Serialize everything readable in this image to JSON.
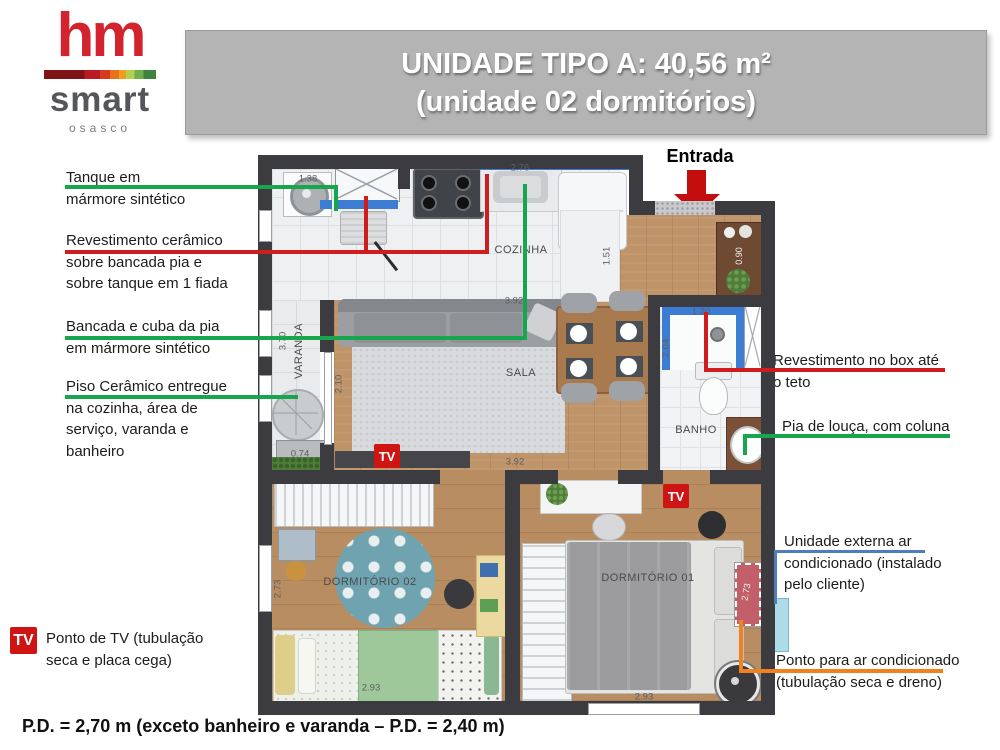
{
  "logo": {
    "hm": "hm",
    "smart": "smart",
    "city": "osasco"
  },
  "banner": {
    "line1": "UNIDADE TIPO A: 40,56 m²",
    "line2": "(unidade 02 dormitórios)"
  },
  "annotations": {
    "left": [
      {
        "id": "tanque",
        "text": "Tanque em\nmármore sintético",
        "line_color": "green"
      },
      {
        "id": "revestimento-ceramico",
        "text": "Revestimento cerâmico\nsobre bancada pia e\nsobre tanque em 1 fiada",
        "line_color": "red"
      },
      {
        "id": "bancada-cuba",
        "text": "Bancada e cuba da pia\nem mármore sintético",
        "line_color": "green"
      },
      {
        "id": "piso-ceramico",
        "text": "Piso Cerâmico entregue\nna cozinha, área de\nserviço, varanda e\nbanheiro",
        "line_color": "green"
      }
    ],
    "right": [
      {
        "id": "revestimento-box",
        "text": "Revestimento no box até\no teto",
        "line_color": "red"
      },
      {
        "id": "pia-louca",
        "text": "Pia de louça, com coluna",
        "line_color": "green"
      },
      {
        "id": "unidade-externa-ac",
        "text": "Unidade externa ar\ncondicionado (instalado\npelo cliente)",
        "line_color": "blue"
      },
      {
        "id": "ponto-ac",
        "text": "Ponto para ar condicionado\n(tubulação seca e dreno)",
        "line_color": "orange"
      }
    ]
  },
  "tv_legend": {
    "icon": "TV",
    "text": "Ponto de TV (tubulação\nseca e placa cega)"
  },
  "footer": "P.D. = 2,70 m (exceto banheiro e varanda – P.D. = 2,40 m)",
  "plan": {
    "entrada_label": "Entrada",
    "tv_label": "TV",
    "labels": [
      {
        "text": "COZINHA",
        "cx": 263,
        "cy": 95,
        "rot": 0,
        "kind": "room"
      },
      {
        "text": "SALA",
        "cx": 263,
        "cy": 218,
        "rot": 0,
        "kind": "room"
      },
      {
        "text": "BANHO",
        "cx": 438,
        "cy": 275,
        "rot": 0,
        "kind": "room"
      },
      {
        "text": "VARANDA",
        "cx": 41,
        "cy": 196,
        "rot": -90,
        "kind": "room"
      },
      {
        "text": "DORMITÓRIO 02",
        "cx": 112,
        "cy": 427,
        "rot": 0,
        "kind": "room"
      },
      {
        "text": "DORMITÓRIO 01",
        "cx": 390,
        "cy": 423,
        "rot": 0,
        "kind": "room"
      },
      {
        "text": "1.38",
        "cx": 50,
        "cy": 24,
        "rot": 0,
        "kind": "dim"
      },
      {
        "text": "2.76",
        "cx": 262,
        "cy": 13,
        "rot": 0,
        "kind": "dim"
      },
      {
        "text": "1.51",
        "cx": 349,
        "cy": 101,
        "rot": -90,
        "kind": "dim"
      },
      {
        "text": "3.92",
        "cx": 256,
        "cy": 146,
        "rot": 0,
        "kind": "dim"
      },
      {
        "text": "3.92",
        "cx": 257,
        "cy": 307,
        "rot": 0,
        "kind": "dim"
      },
      {
        "text": "2.10",
        "cx": 81,
        "cy": 229,
        "rot": -90,
        "kind": "dim"
      },
      {
        "text": "3.70",
        "cx": 25,
        "cy": 186,
        "rot": -90,
        "kind": "dim"
      },
      {
        "text": "0.74",
        "cx": 42,
        "cy": 299,
        "rot": 0,
        "kind": "dim"
      },
      {
        "text": "0.90",
        "cx": 481,
        "cy": 101,
        "rot": -90,
        "kind": "dim-light"
      },
      {
        "text": "1.20",
        "cx": 443,
        "cy": 157,
        "rot": 0,
        "kind": "dim"
      },
      {
        "text": "2.04",
        "cx": 408,
        "cy": 193,
        "rot": -90,
        "kind": "dim"
      },
      {
        "text": "2.73",
        "cx": 20,
        "cy": 434,
        "rot": -90,
        "kind": "dim"
      },
      {
        "text": "2.93",
        "cx": 113,
        "cy": 533,
        "rot": 0,
        "kind": "dim"
      },
      {
        "text": "2.93",
        "cx": 386,
        "cy": 542,
        "rot": 0,
        "kind": "dim"
      },
      {
        "text": "2.73",
        "cx": 488,
        "cy": 437,
        "rot": -80,
        "kind": "dim-light"
      }
    ]
  },
  "colors": {
    "logo_red": "#d2232e",
    "banner_bg": "#b4b4b4",
    "wall": "#3c3c40",
    "green_line": "#17a54e",
    "red_line": "#cf1d1f",
    "orange_line": "#f0811f",
    "blue_line": "#4d7dbb",
    "tv_red": "#cf1414",
    "entrada_arrow": "#c40d0d",
    "blue_tile": "#3d7cd3",
    "ac_unit_blue": "#aedbe8",
    "ac_point_red": "#c25f68",
    "rug_teal": "#6fa3b0"
  }
}
